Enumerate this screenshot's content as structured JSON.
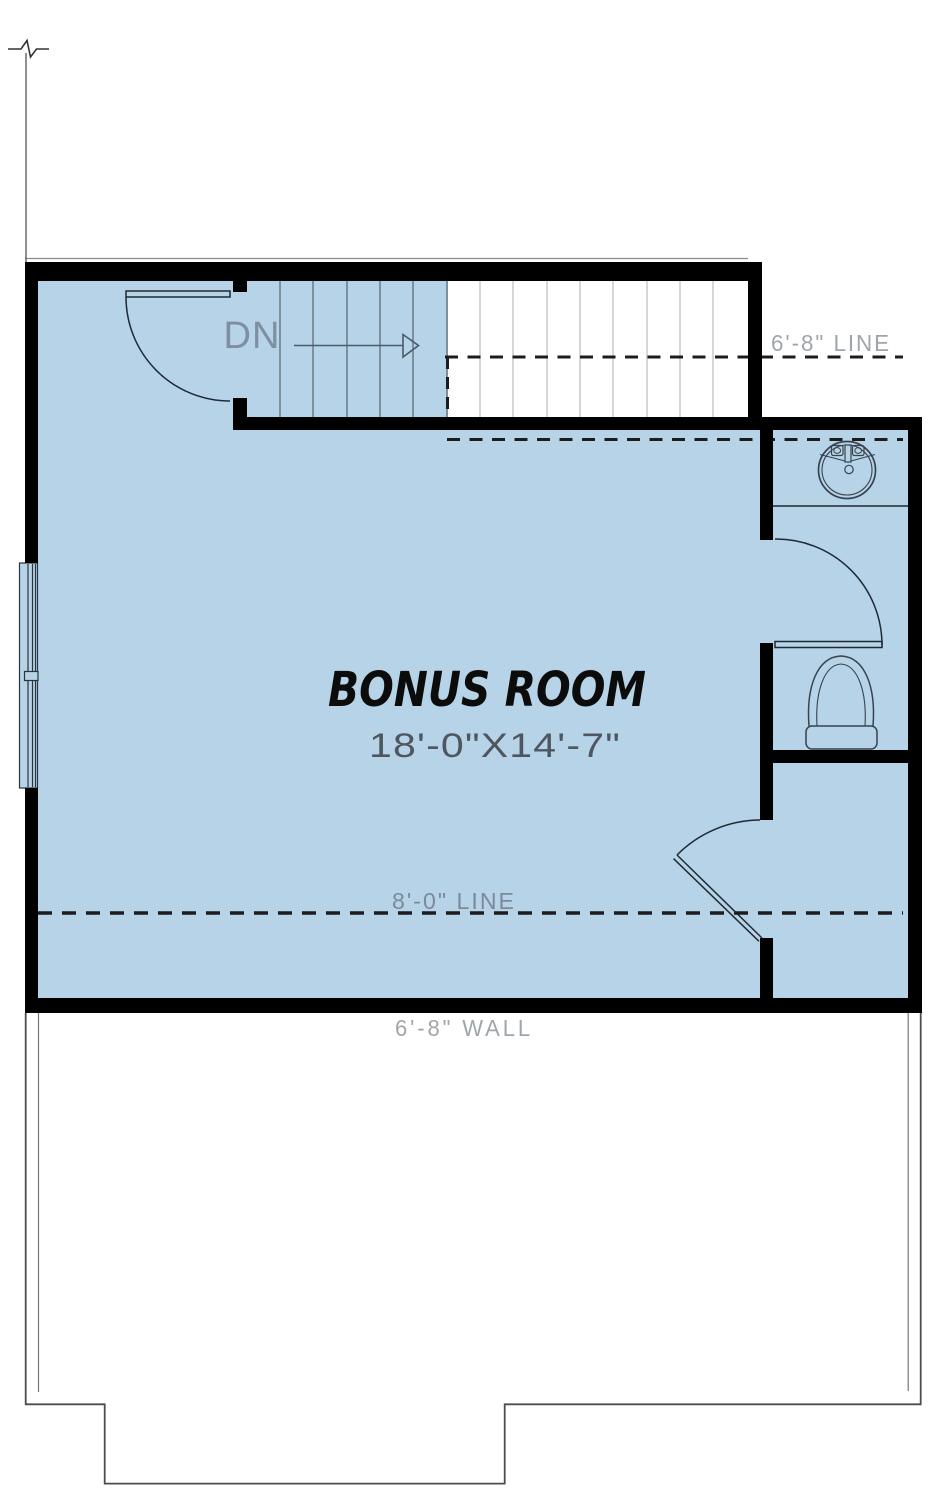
{
  "room": {
    "title": "BONUS ROOM",
    "dimensions": "18'-0\"X14'-7\""
  },
  "stairs": {
    "direction_label": "DN"
  },
  "annotations": {
    "ceiling_line_upper": "6'-8\" LINE",
    "ceiling_line_lower": "8'-0\" LINE",
    "wall_height": "6'-8\" WALL"
  },
  "fixtures": {
    "sink": "round-lavatory-sink",
    "toilet": "toilet",
    "window": "double-window",
    "doors": [
      "bonus-room-entry-door",
      "bathroom-door",
      "storage-door"
    ]
  },
  "colors": {
    "floor_fill": "#b7d3e8",
    "wall": "#000000",
    "dashed_line": "#1c1c1c",
    "title_text": "#0c0c0c",
    "dimension_text": "#4e5760",
    "annotation_text_on_white": "#9fa6ab",
    "annotation_text_on_blue": "#7b8b99",
    "fixture_line": "#37434d",
    "tread_line_on_blue": "#66737f",
    "tread_line_on_white": "#c3c7ca"
  }
}
